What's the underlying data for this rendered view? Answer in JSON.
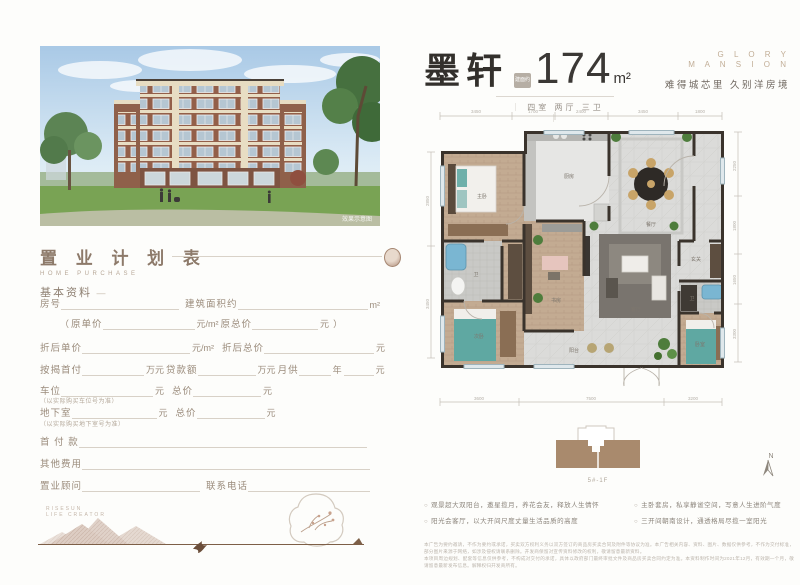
{
  "left": {
    "photo_watermark": "效果示意图",
    "plan_title": "置 业 计 划 表",
    "plan_subtitle": "HOME PURCHASE",
    "section_basic": "基本资料",
    "section_dash": "—",
    "form": {
      "room": {
        "label": "房号"
      },
      "area": {
        "label": "建筑面积约",
        "unit": "m²"
      },
      "orig": {
        "open": "（",
        "price_label": "原单价",
        "price_unit": "元/m²",
        "total_label": "原总价",
        "total_unit": "元",
        "close": "）"
      },
      "disc_price": {
        "label": "折后单价",
        "unit": "元/m²"
      },
      "disc_total": {
        "label": "折后总价",
        "unit": "元"
      },
      "down": {
        "label": "按揭首付",
        "unit": "万元"
      },
      "loan": {
        "label": "贷款额",
        "unit": "万元"
      },
      "monthly": {
        "label": "月供",
        "mid": "年",
        "unit": "元"
      },
      "parking": {
        "label": "车位",
        "unit": "元",
        "note": "（以实际购买车位号为准）"
      },
      "parking_total": {
        "label": "总价",
        "unit": "元"
      },
      "basement": {
        "label": "地下室",
        "unit": "元",
        "note": "（以实际购买地下室号为准）"
      },
      "basement_total": {
        "label": "总价",
        "unit": "元"
      },
      "downpay": {
        "label": "首 付 款"
      },
      "other": {
        "label": "其他费用"
      },
      "consultant": {
        "label": "置业顾问"
      },
      "phone": {
        "label": "联系电话"
      }
    },
    "footer_brand1": "RISESUN",
    "footer_brand2": "LIFE CREATOR"
  },
  "unit": {
    "name": "墨轩",
    "stamp": "建面约",
    "area": "174",
    "area_unit": "m²",
    "layout": "四室 两厅 三卫",
    "layout_bar": "｜",
    "brand_line1": "G L O R Y",
    "brand_line2": "M A N S I O N",
    "slogan": "难得城芯里  久别洋房境"
  },
  "floorplan": {
    "dims_top": [
      "3450",
      "1700",
      "2400",
      "3450",
      "1800"
    ],
    "dims_bottom": [
      "3600",
      "7500",
      "3200"
    ],
    "dims_left": [
      "2850",
      "3450"
    ],
    "dims_right": [
      "2250",
      "1800",
      "1650",
      "3300"
    ],
    "rooms": {
      "master": "主卧",
      "bath1": "卫",
      "bed2": "次卧",
      "kitchen": "厨房",
      "study": "书房",
      "dining": "餐厅",
      "living": "客厅",
      "balcony": "阳台",
      "foyer": "玄关",
      "bed3": "卧室",
      "bath2": "卫"
    },
    "footprint_label": "5#-1F",
    "compass_n": "N"
  },
  "bullets": [
    "观景超大双阳台，邀星揽月，养花会友，释放人生情怀",
    "阳光会客厅，以大开间尺度丈量生活品质的高度",
    "主卧套房，私享静谧空间，写意人生进阶气度",
    "三开间朝南设计，通透格局尽揽一室阳光"
  ],
  "disclaimer_line1": "本广告为要约邀请，不作为要约或承诺，买卖双方权利义务以双方签订的商品房买卖合同及附件等协议为准。本广告相关内容、资料、图片、数据仅供参考，不作为交付标准，部分图片来源于网络，如涉及侵权请联系删除。开发商保留对宣传资料修改的权利，敬请留意最新资料。",
  "disclaimer_line2": "本项目周边规划、配套等信息仅供参考，不构成对交付的承诺，具体以政府部门最终审批文件及商品房买卖合同约定为准。本资料制作时间为2021年12月，有效期一个月，敬请留意最新发布信息。解释权归开发商所有。"
}
